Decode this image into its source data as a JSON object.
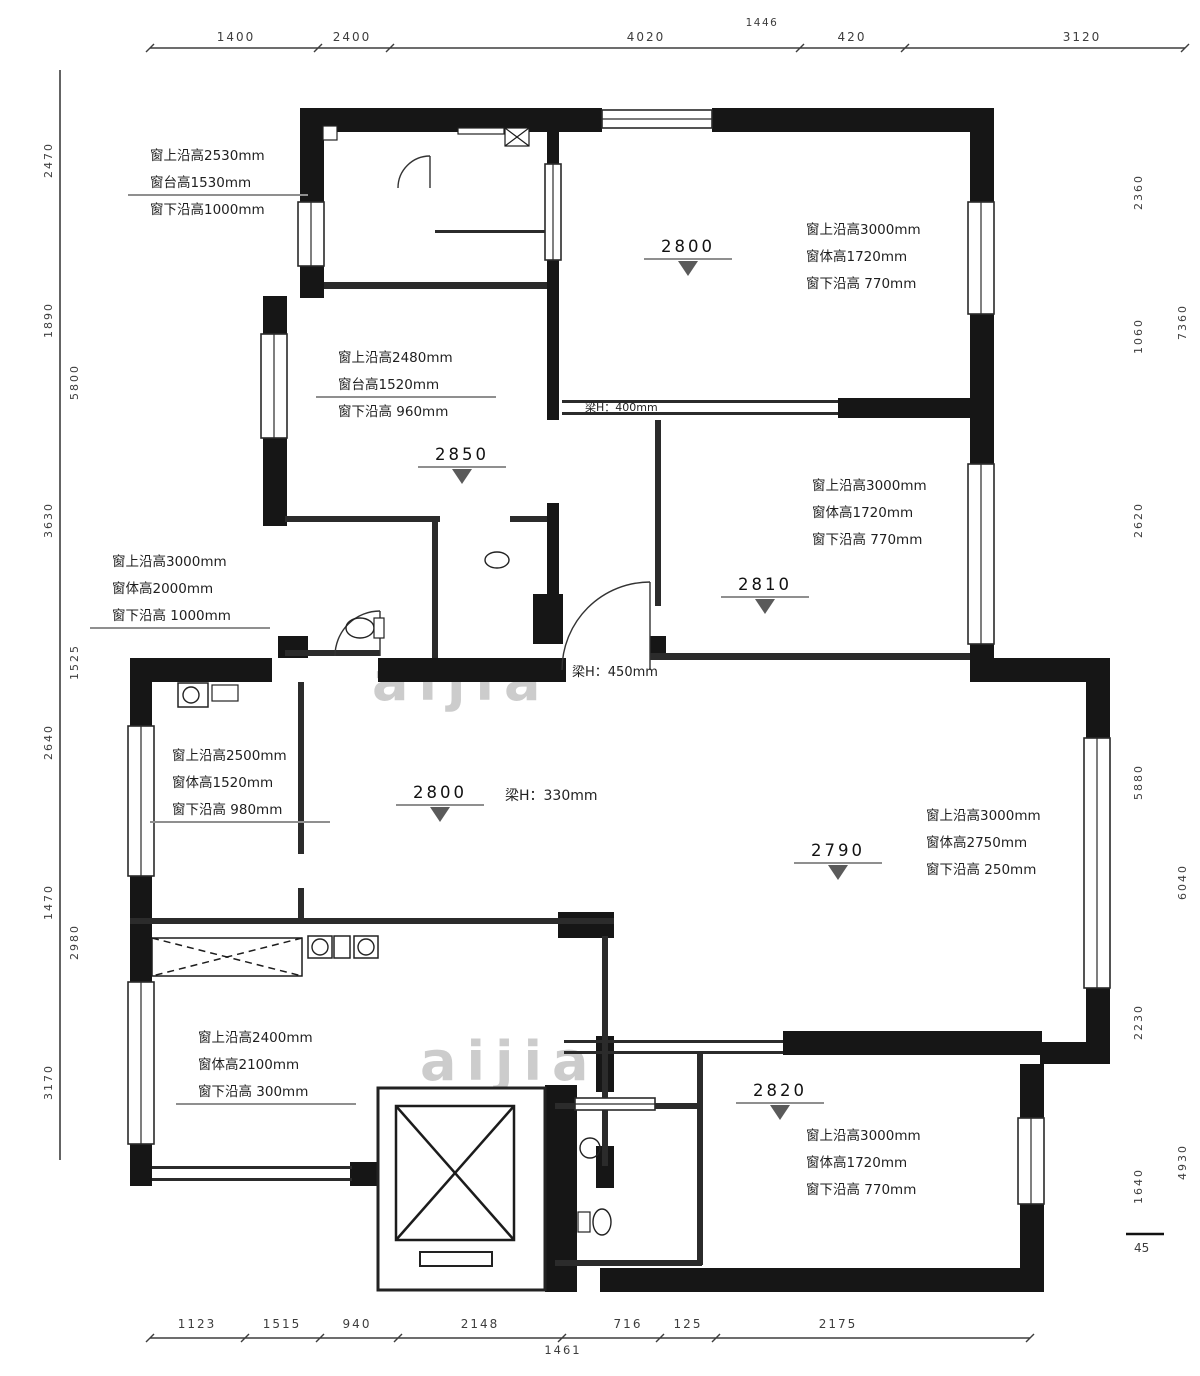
{
  "watermark": "aijia",
  "colors": {
    "wall": "#161616",
    "partition": "#2b2b2b",
    "window_stroke": "#2a2a2a",
    "text": "#1f1f1f",
    "dim": "#3d3d3d",
    "leader": "#8f8f8f",
    "triangle": "#5a5a5a",
    "watermark": "#9b9b9b"
  },
  "plan": {
    "walls": [
      [
        300,
        108,
        262,
        24
      ],
      [
        562,
        108,
        40,
        24
      ],
      [
        712,
        108,
        282,
        24
      ],
      [
        970,
        132,
        24,
        72
      ],
      [
        970,
        312,
        24,
        106
      ],
      [
        838,
        398,
        156,
        20
      ],
      [
        970,
        416,
        24,
        48
      ],
      [
        970,
        643,
        24,
        19
      ],
      [
        970,
        658,
        140,
        24
      ],
      [
        1086,
        682,
        24,
        56
      ],
      [
        1086,
        986,
        24,
        58
      ],
      [
        1040,
        1042,
        70,
        22
      ],
      [
        1020,
        1064,
        24,
        54
      ],
      [
        1020,
        1202,
        24,
        90
      ],
      [
        600,
        1268,
        442,
        24
      ],
      [
        130,
        658,
        142,
        24
      ],
      [
        130,
        682,
        22,
        46
      ],
      [
        130,
        874,
        22,
        62
      ],
      [
        130,
        936,
        22,
        48
      ],
      [
        130,
        1142,
        22,
        44
      ],
      [
        350,
        1162,
        36,
        24
      ],
      [
        300,
        108,
        24,
        96
      ],
      [
        300,
        264,
        24,
        34
      ],
      [
        263,
        296,
        24,
        40
      ],
      [
        263,
        436,
        24,
        90
      ],
      [
        533,
        594,
        30,
        50
      ],
      [
        378,
        658,
        188,
        24
      ],
      [
        545,
        1085,
        32,
        207
      ],
      [
        783,
        1031,
        259,
        24
      ],
      [
        558,
        912,
        56,
        26
      ],
      [
        596,
        1036,
        18,
        56
      ],
      [
        596,
        1146,
        18,
        42
      ],
      [
        650,
        636,
        16,
        24
      ],
      [
        278,
        636,
        30,
        22
      ],
      [
        547,
        130,
        12,
        38
      ],
      [
        547,
        258,
        12,
        162
      ],
      [
        547,
        503,
        12,
        93
      ]
    ],
    "partitions": [
      [
        324,
        282,
        223,
        7
      ],
      [
        285,
        516,
        155,
        6
      ],
      [
        510,
        516,
        37,
        6
      ],
      [
        432,
        522,
        6,
        136
      ],
      [
        285,
        650,
        95,
        6
      ],
      [
        655,
        420,
        6,
        186
      ],
      [
        650,
        653,
        320,
        7
      ],
      [
        130,
        918,
        484,
        6
      ],
      [
        602,
        936,
        6,
        230
      ],
      [
        298,
        682,
        6,
        172
      ],
      [
        298,
        888,
        6,
        34
      ],
      [
        697,
        1053,
        6,
        52
      ],
      [
        697,
        1105,
        6,
        160
      ],
      [
        555,
        1103,
        22,
        6
      ],
      [
        653,
        1103,
        47,
        6
      ],
      [
        555,
        1260,
        147,
        6
      ],
      [
        562,
        400,
        276,
        3
      ],
      [
        562,
        412,
        276,
        3
      ],
      [
        564,
        1040,
        219,
        3
      ],
      [
        564,
        1051,
        219,
        3
      ],
      [
        152,
        1166,
        200,
        3
      ],
      [
        152,
        1178,
        200,
        3
      ],
      [
        435,
        230,
        112,
        3
      ]
    ],
    "windows": [
      {
        "x": 298,
        "y": 202,
        "w": 26,
        "h": 64,
        "dir": "v"
      },
      {
        "x": 261,
        "y": 334,
        "w": 26,
        "h": 104,
        "dir": "v"
      },
      {
        "x": 128,
        "y": 726,
        "w": 26,
        "h": 150,
        "dir": "v"
      },
      {
        "x": 128,
        "y": 982,
        "w": 26,
        "h": 162,
        "dir": "v"
      },
      {
        "x": 968,
        "y": 202,
        "w": 26,
        "h": 112,
        "dir": "v"
      },
      {
        "x": 968,
        "y": 464,
        "w": 26,
        "h": 180,
        "dir": "v"
      },
      {
        "x": 1084,
        "y": 738,
        "w": 26,
        "h": 250,
        "dir": "v"
      },
      {
        "x": 1018,
        "y": 1118,
        "w": 26,
        "h": 86,
        "dir": "v"
      },
      {
        "x": 545,
        "y": 164,
        "w": 16,
        "h": 96,
        "dir": "v"
      },
      {
        "x": 575,
        "y": 1098,
        "w": 80,
        "h": 12,
        "dir": "h"
      },
      {
        "x": 602,
        "y": 110,
        "w": 110,
        "h": 18,
        "dir": "h"
      }
    ],
    "doors": [
      {
        "name": "door-arc",
        "d": "M430,156 A32,32 0 0 0 398,188"
      },
      {
        "name": "door-leaf",
        "d": "M430,156 L430,188"
      },
      {
        "name": "entry-door-arc",
        "d": "M650,582 A88,88 0 0 0 562,670"
      },
      {
        "name": "entry-door-leaf",
        "d": "M650,670 L650,582"
      },
      {
        "name": "bath-door-arc",
        "d": "M380,611 A45,45 0 0 0 335,656"
      },
      {
        "name": "bath-door-leaf",
        "d": "M380,656 L380,611"
      }
    ],
    "fixtures": [
      {
        "name": "elevator-shaft",
        "shape": "rect",
        "x": 378,
        "y": 1088,
        "w": 167,
        "h": 202,
        "sw": 3
      },
      {
        "name": "elevator-cab",
        "shape": "xbox",
        "x": 396,
        "y": 1106,
        "w": 118,
        "h": 134,
        "sw": 2.5
      },
      {
        "name": "elevator-door",
        "shape": "rect",
        "x": 420,
        "y": 1252,
        "w": 72,
        "h": 14,
        "sw": 2
      },
      {
        "name": "kitchen-counter",
        "shape": "xbox-dashed",
        "x": 152,
        "y": 938,
        "w": 150,
        "h": 38,
        "sw": 1.5
      },
      {
        "name": "stove-burner-left",
        "shape": "rect",
        "x": 308,
        "y": 936,
        "w": 24,
        "h": 22,
        "sw": 1.5
      },
      {
        "name": "stove-burner-left-ring",
        "shape": "circle",
        "cx": 320,
        "cy": 947,
        "r": 8
      },
      {
        "name": "gas-meter",
        "shape": "rect",
        "x": 334,
        "y": 936,
        "w": 16,
        "h": 22,
        "sw": 1.5
      },
      {
        "name": "stove-burner-right",
        "shape": "rect",
        "x": 354,
        "y": 936,
        "w": 24,
        "h": 22,
        "sw": 1.5
      },
      {
        "name": "stove-burner-right-ring",
        "shape": "circle",
        "cx": 366,
        "cy": 947,
        "r": 8
      },
      {
        "name": "washing-machine",
        "shape": "rect",
        "x": 178,
        "y": 683,
        "w": 30,
        "h": 24,
        "sw": 1.5
      },
      {
        "name": "washing-machine-drum",
        "shape": "circle",
        "cx": 191,
        "cy": 695,
        "r": 8
      },
      {
        "name": "cabinet",
        "shape": "rect",
        "x": 212,
        "y": 685,
        "w": 26,
        "h": 16,
        "sw": 1.2
      },
      {
        "name": "toilet",
        "shape": "ellipse",
        "cx": 360,
        "cy": 628,
        "rx": 14,
        "ry": 10
      },
      {
        "name": "toilet-tank",
        "shape": "rect",
        "x": 374,
        "y": 618,
        "w": 10,
        "h": 20,
        "sw": 1.2
      },
      {
        "name": "basin",
        "shape": "ellipse",
        "cx": 497,
        "cy": 560,
        "rx": 12,
        "ry": 8
      },
      {
        "name": "toilet-2",
        "shape": "ellipse",
        "cx": 602,
        "cy": 1222,
        "rx": 9,
        "ry": 13
      },
      {
        "name": "toilet-tank-2",
        "shape": "rect",
        "x": 578,
        "y": 1212,
        "w": 12,
        "h": 20,
        "sw": 1.2
      },
      {
        "name": "basin-2",
        "shape": "circle",
        "cx": 590,
        "cy": 1148,
        "r": 10
      },
      {
        "name": "closet",
        "shape": "rect",
        "x": 323,
        "y": 126,
        "w": 14,
        "h": 14,
        "sw": 1.2
      },
      {
        "name": "shelf",
        "shape": "rect",
        "x": 458,
        "y": 128,
        "w": 46,
        "h": 6,
        "sw": 1.2
      },
      {
        "name": "vent-shaft",
        "shape": "xbox",
        "x": 505,
        "y": 128,
        "w": 24,
        "h": 18,
        "sw": 1.2
      }
    ]
  },
  "annotations": [
    {
      "x": 150,
      "y": 160,
      "ul": 2,
      "lines": [
        "窗上沿高2530mm",
        "窗台高1530mm",
        "窗下沿高1000mm"
      ]
    },
    {
      "x": 338,
      "y": 362,
      "ul": 2,
      "lines": [
        "窗上沿高2480mm",
        "窗台高1520mm",
        "窗下沿高 960mm"
      ]
    },
    {
      "x": 112,
      "y": 566,
      "ul": 3,
      "lines": [
        "窗上沿高3000mm",
        "窗体高2000mm",
        "窗下沿高 1000mm"
      ]
    },
    {
      "x": 172,
      "y": 760,
      "ul": 3,
      "lines": [
        "窗上沿高2500mm",
        "窗体高1520mm",
        "窗下沿高 980mm"
      ]
    },
    {
      "x": 806,
      "y": 234,
      "ul": 0,
      "lines": [
        "窗上沿高3000mm",
        "窗体高1720mm",
        "窗下沿高 770mm"
      ]
    },
    {
      "x": 812,
      "y": 490,
      "ul": 0,
      "lines": [
        "窗上沿高3000mm",
        "窗体高1720mm",
        "窗下沿高 770mm"
      ]
    },
    {
      "x": 926,
      "y": 820,
      "ul": 0,
      "lines": [
        "窗上沿高3000mm",
        "窗体高2750mm",
        "窗下沿高 250mm"
      ]
    },
    {
      "x": 198,
      "y": 1042,
      "ul": 3,
      "lines": [
        "窗上沿高2400mm",
        "窗体高2100mm",
        "窗下沿高 300mm"
      ]
    },
    {
      "x": 806,
      "y": 1140,
      "ul": 0,
      "lines": [
        "窗上沿高3000mm",
        "窗体高1720mm",
        "窗下沿高 770mm"
      ]
    }
  ],
  "levels": [
    {
      "v": "2800",
      "x": 688,
      "y": 252
    },
    {
      "v": "2850",
      "x": 462,
      "y": 460
    },
    {
      "v": "2810",
      "x": 765,
      "y": 590
    },
    {
      "v": "2800",
      "x": 440,
      "y": 798
    },
    {
      "v": "2790",
      "x": 838,
      "y": 856
    },
    {
      "v": "2820",
      "x": 780,
      "y": 1096
    }
  ],
  "beams": [
    {
      "t": "梁H：330mm",
      "x": 505,
      "y": 800,
      "size": 14
    },
    {
      "t": "梁H：450mm",
      "x": 572,
      "y": 676,
      "size": 13
    },
    {
      "t": "梁H：400mm",
      "x": 585,
      "y": 411,
      "size": 11
    }
  ],
  "dims": {
    "top": {
      "line": {
        "x1": 150,
        "y": 48,
        "x2": 1185
      },
      "ticks": [
        150,
        318,
        390,
        800,
        905,
        1185
      ],
      "labels": [
        {
          "t": "1400",
          "x": 236
        },
        {
          "t": "2400",
          "x": 352
        },
        {
          "t": "4020",
          "x": 646
        },
        {
          "t": "420",
          "x": 852
        },
        {
          "t": "3120",
          "x": 1082
        }
      ],
      "note": {
        "t": "1446",
        "x": 762,
        "y": 26
      }
    },
    "bottom": {
      "line": {
        "x1": 150,
        "y": 1338,
        "x2": 1030
      },
      "ticks": [
        150,
        245,
        320,
        398,
        562,
        660,
        716,
        1030
      ],
      "labels": [
        {
          "t": "1123",
          "x": 197
        },
        {
          "t": "1515",
          "x": 282
        },
        {
          "t": "940",
          "x": 357
        },
        {
          "t": "2148",
          "x": 480
        },
        {
          "t": "716",
          "x": 628
        },
        {
          "t": "125",
          "x": 688
        },
        {
          "t": "2175",
          "x": 838
        }
      ],
      "total": {
        "t": "1461",
        "x": 563,
        "y": 1354
      }
    },
    "left": {
      "line": {
        "x": 60,
        "y1": 70,
        "y2": 1160
      },
      "col1x": 52,
      "col1": [
        {
          "t": "2470",
          "y": 160
        },
        {
          "t": "1890",
          "y": 320
        },
        {
          "t": "3630",
          "y": 520
        },
        {
          "t": "2640",
          "y": 742
        },
        {
          "t": "1470",
          "y": 902
        },
        {
          "t": "3170",
          "y": 1082
        }
      ],
      "col2x": 78,
      "col2": [
        {
          "t": "5800",
          "y": 382
        },
        {
          "t": "1525",
          "y": 662
        },
        {
          "t": "2980",
          "y": 942
        }
      ]
    },
    "right": {
      "col1x": 1142,
      "col1": [
        {
          "t": "2360",
          "y": 192
        },
        {
          "t": "1060",
          "y": 336
        },
        {
          "t": "2620",
          "y": 520
        },
        {
          "t": "5880",
          "y": 782
        },
        {
          "t": "2230",
          "y": 1022
        },
        {
          "t": "1640",
          "y": 1186
        }
      ],
      "col2x": 1186,
      "col2": [
        {
          "t": "7360",
          "y": 322
        },
        {
          "t": "6040",
          "y": 882
        },
        {
          "t": "4930",
          "y": 1162
        }
      ],
      "mark": {
        "t": "45",
        "x": 1134,
        "y": 1252,
        "lineY": 1234
      }
    }
  },
  "watermarks": [
    {
      "x": 372,
      "y": 700
    },
    {
      "x": 420,
      "y": 1080
    }
  ]
}
